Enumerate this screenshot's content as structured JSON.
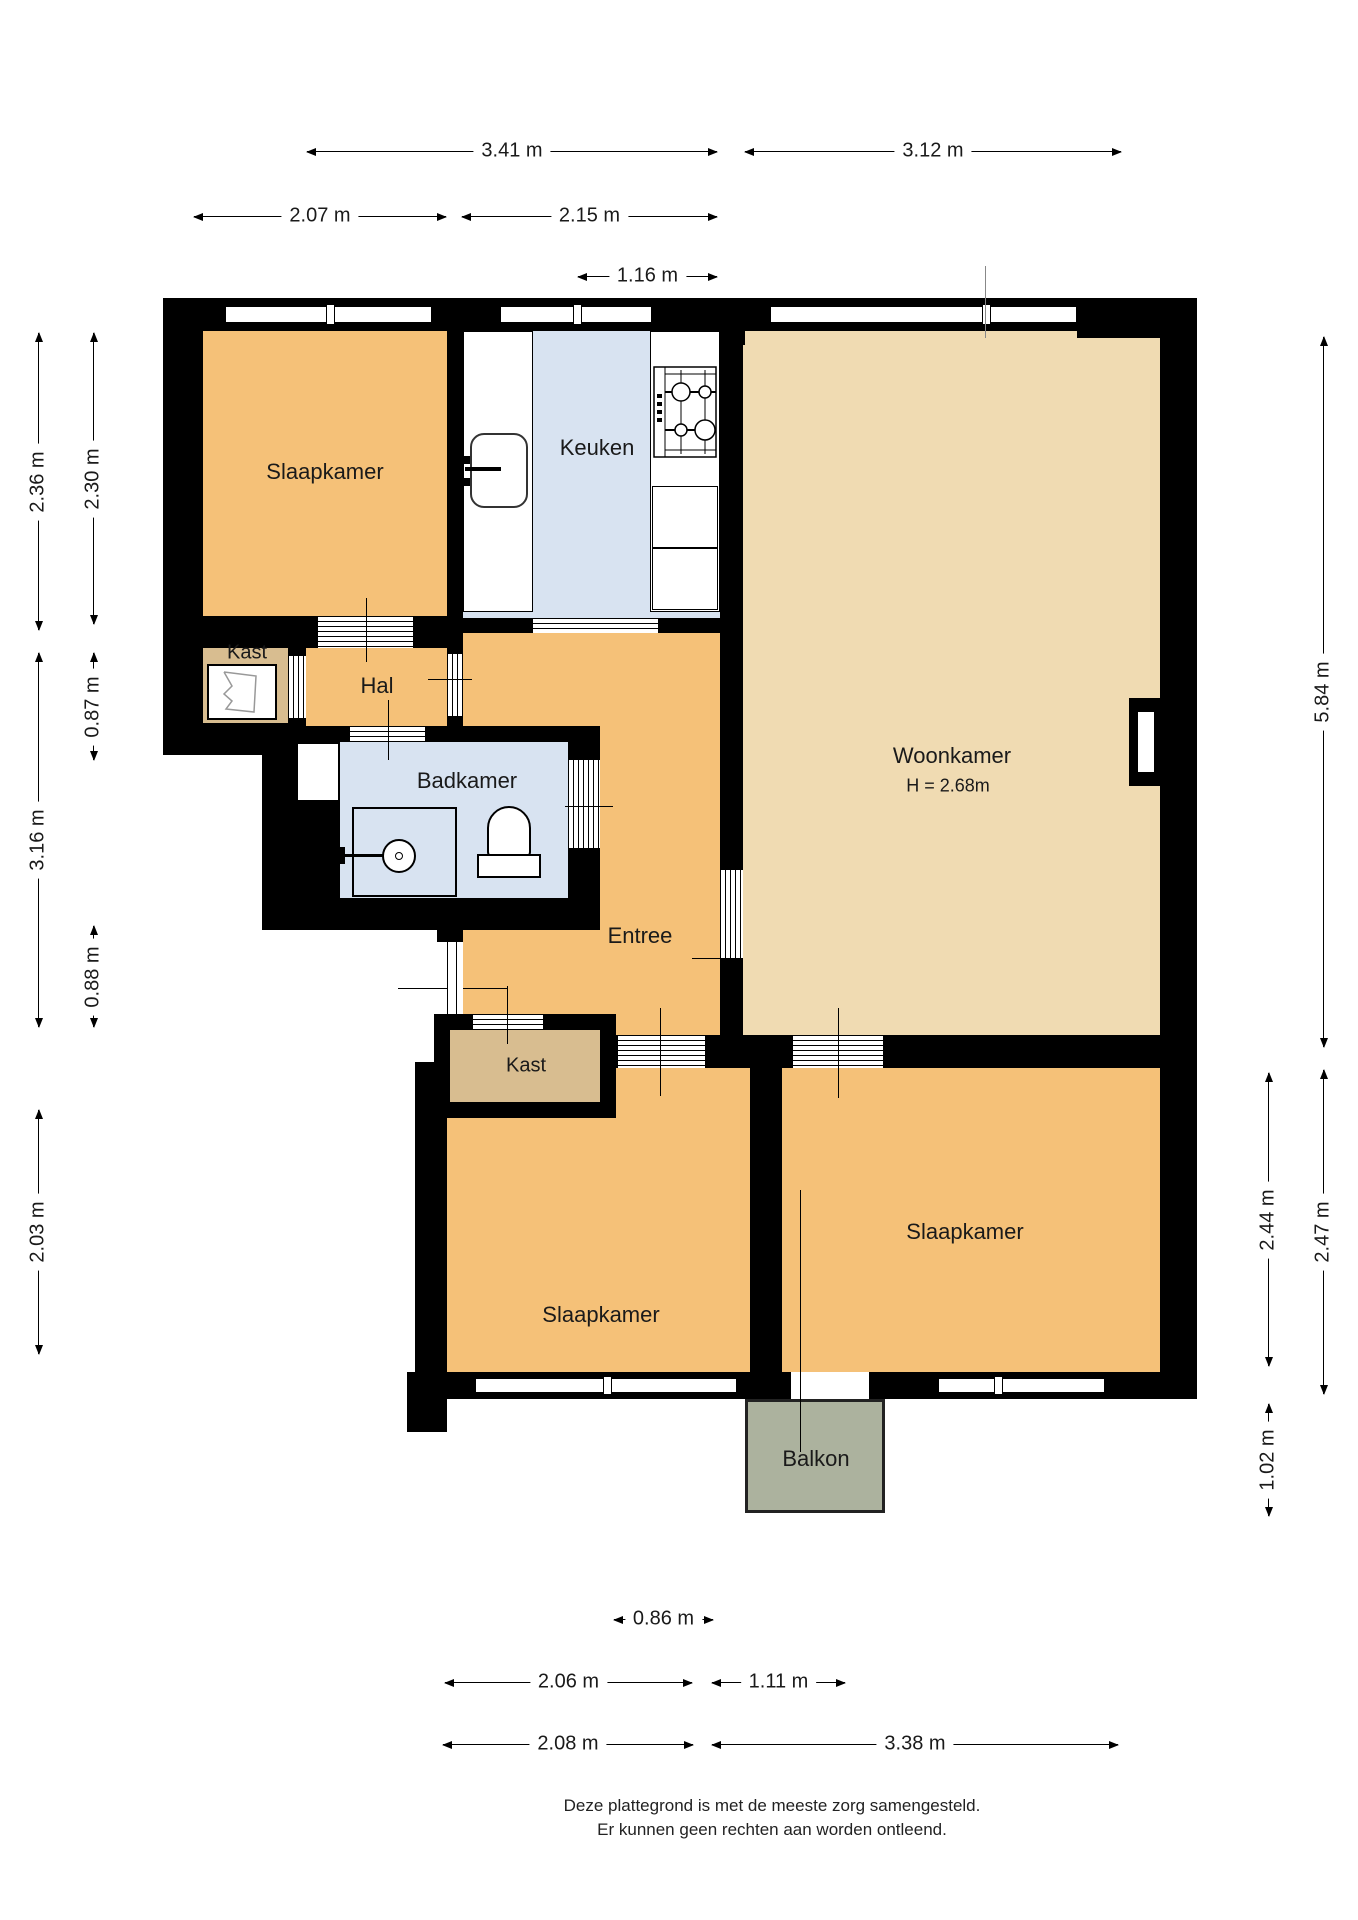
{
  "plan": {
    "rooms": {
      "slaapkamer_1": "Slaapkamer",
      "kast_1": "Kast",
      "hal": "Hal",
      "badkamer": "Badkamer",
      "keuken": "Keuken",
      "woonkamer": "Woonkamer",
      "woonkamer_height": "H = 2.68m",
      "entree": "Entree",
      "kast_2": "Kast",
      "slaapkamer_2": "Slaapkamer",
      "slaapkamer_3": "Slaapkamer",
      "balkon": "Balkon"
    },
    "dims": {
      "top": [
        "3.41 m",
        "3.12 m",
        "2.07 m",
        "2.15 m",
        "1.16 m"
      ],
      "left": [
        "2.36 m",
        "2.30 m",
        "0.87 m",
        "3.16 m",
        "0.88 m",
        "2.03 m"
      ],
      "right": [
        "5.84 m",
        "2.44 m",
        "2.47 m",
        "1.02 m"
      ],
      "bottom": [
        "0.86 m",
        "2.06 m",
        "1.11 m",
        "2.08 m",
        "3.38 m"
      ]
    },
    "colors": {
      "wall": "#000000",
      "room_orange": "#F5C178",
      "living": "#F0DBB2",
      "wet_blue": "#D8E3F1",
      "closet": "#D8BD90",
      "balcony": "#ACB29E"
    },
    "icons": [
      "sink-icon",
      "stove-icon",
      "toilet-icon",
      "shower-icon",
      "meter-icon"
    ]
  },
  "footer": {
    "line1": "Deze plattegrond is met de meeste zorg samengesteld.",
    "line2": "Er kunnen geen rechten aan worden ontleend."
  }
}
